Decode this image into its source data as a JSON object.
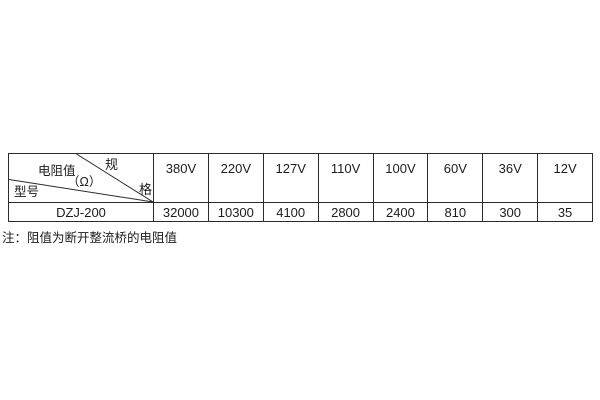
{
  "colors": {
    "background": "#ffffff",
    "border": "#2b2b2b",
    "text": "#1c1c1c"
  },
  "table": {
    "corner": {
      "spec_char_top": "规",
      "spec_char_bottom": "格",
      "resistance_label": "电阻值",
      "resistance_unit": "（Ω）",
      "model_label": "型号"
    },
    "columns": [
      "380V",
      "220V",
      "127V",
      "110V",
      "100V",
      "60V",
      "36V",
      "12V"
    ],
    "rows": [
      {
        "model": "DZJ-200",
        "values": [
          "32000",
          "10300",
          "4100",
          "2800",
          "2400",
          "810",
          "300",
          "35"
        ]
      }
    ]
  },
  "note": "注：阻值为断开整流桥的电阻值"
}
